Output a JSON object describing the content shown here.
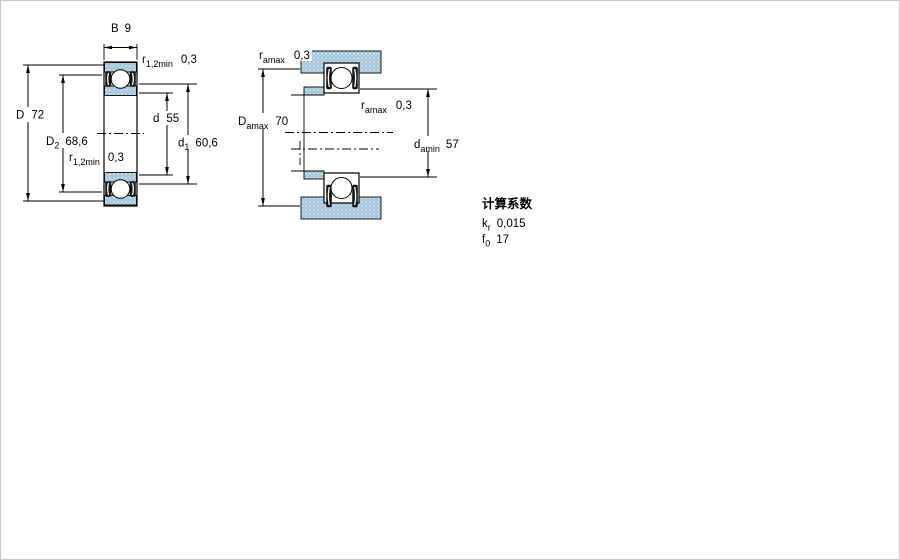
{
  "left_view": {
    "dim_B": {
      "symbol": "B",
      "value": "9"
    },
    "dim_D": {
      "symbol": "D",
      "value": "72"
    },
    "dim_D2": {
      "symbol": "D",
      "sub": "2",
      "value": "68,6"
    },
    "dim_r_top": {
      "symbol": "r",
      "sub": "1,2min",
      "value": "0,3"
    },
    "dim_r_bottom": {
      "symbol": "r",
      "sub": "1,2min",
      "value": "0,3"
    },
    "dim_d": {
      "symbol": "d",
      "value": "55"
    },
    "dim_d1": {
      "symbol": "d",
      "sub": "1",
      "value": "60,6"
    }
  },
  "right_view": {
    "dim_ramax_top": {
      "symbol": "r",
      "sub": "amax",
      "value": "0,3"
    },
    "dim_ramax_mid": {
      "symbol": "r",
      "sub": "amax",
      "value": "0,3"
    },
    "dim_Damax": {
      "symbol": "D",
      "sub": "amax",
      "value": "70"
    },
    "dim_damin": {
      "symbol": "d",
      "sub": "amin",
      "value": "57"
    }
  },
  "calculation_factors": {
    "title": "计算系数",
    "rows": [
      {
        "symbol": "k",
        "sub": "r",
        "value": "0,015"
      },
      {
        "symbol": "f",
        "sub": "0",
        "value": "17"
      }
    ]
  },
  "colors": {
    "hatch_base": "#9fc3da",
    "hatch_dot_light": "#d8e6f0",
    "hatch_dot_mid": "#c2d6e6",
    "line": "#000000"
  }
}
